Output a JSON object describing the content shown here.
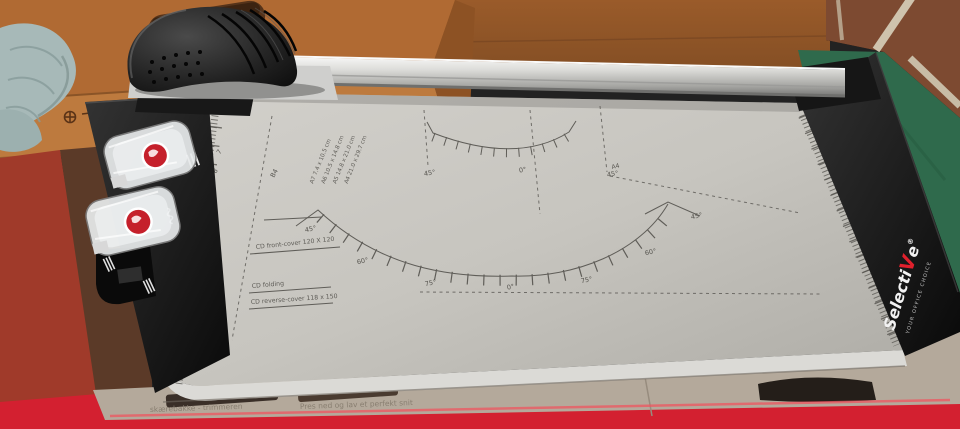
{
  "scene": {
    "background": {
      "cardboard_color": "#a8622e",
      "table_red": "#d32030",
      "table_green": "#2f6a4c",
      "brick_color": "#7d4a31",
      "cloth_color": "#a7b9b8"
    },
    "product_box": {
      "left_text": "skærebakke - trimmeren",
      "right_text": "Pres ned og lav et perfekt snit"
    },
    "trimmer": {
      "body_color": "#c9c7c1",
      "accent_red": "#c5202b",
      "brand": {
        "part1": "Selecti",
        "accent_letter": "V",
        "part2": "e",
        "registered": "®",
        "tagline": "YOUR OFFICE CHOICE"
      },
      "bed": {
        "ruler_numbers": [
          "7",
          "8",
          "9",
          "10",
          "11",
          "12",
          "13",
          "14",
          "15",
          "16",
          "17"
        ],
        "paper_sizes": [
          "A7  7.4 x 10.5 cm",
          "A6  10.5 x 14.8 cm",
          "A5  14.8 x 21.0 cm",
          "A4  21.0 x 29.7 cm"
        ],
        "format_labels": {
          "b4": "B4",
          "a4": "A4"
        },
        "small_arc_labels": [
          "45°",
          "0°",
          "45°"
        ],
        "large_arc_labels": [
          "45°",
          "60°",
          "75°",
          "0°",
          "75°",
          "60°",
          "45°"
        ],
        "cd_guides": {
          "front_cover": "CD front-cover 120 X 120",
          "folding": "CD folding",
          "reverse_cover": "CD reverse-cover 118 x 150"
        }
      },
      "icons": {
        "straight_cut": "straight-cut-stripes-icon",
        "wave_cut": "wave-cut-icon",
        "cartridge_logo": "red-circle-logo"
      }
    }
  }
}
